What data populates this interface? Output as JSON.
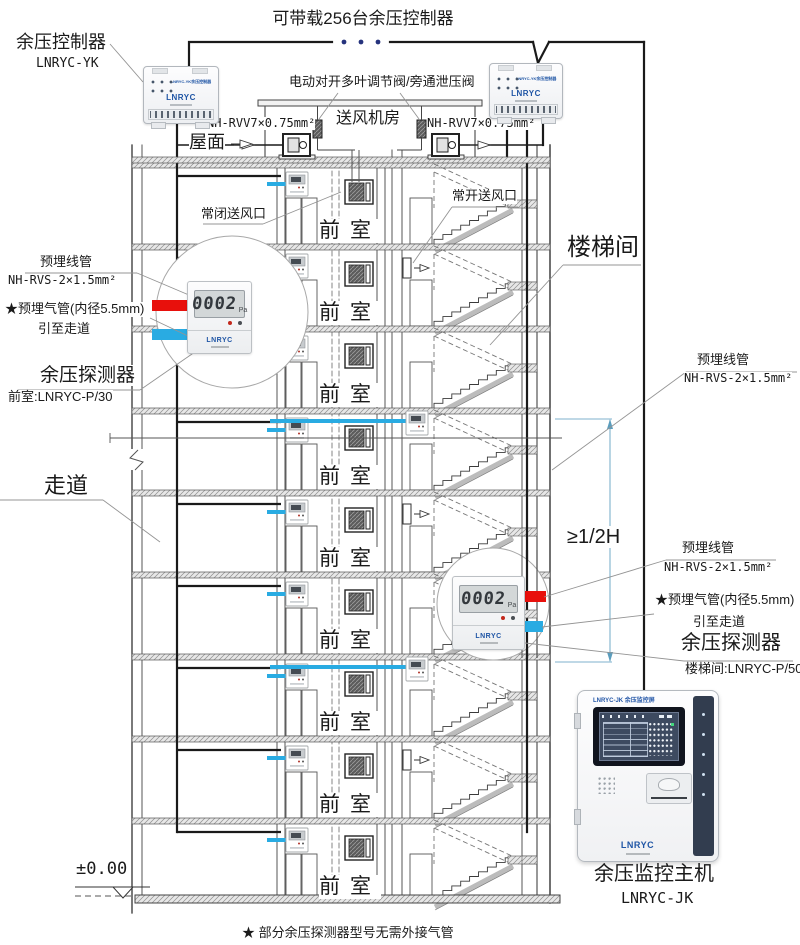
{
  "title": "可带载256台余压控制器",
  "top": {
    "controller_label": "余压控制器",
    "controller_model": "LNRYC-YK",
    "valve_label": "电动对开多叶调节阀/旁通泄压阀",
    "cable_spec": "NH-RVV7×0.75mm²",
    "fan_room_label": "送风机房",
    "roof_label": "屋面"
  },
  "controller_device": {
    "nameplate": "LNRYC-YK余压控制器",
    "logo": "LNRYC"
  },
  "building": {
    "closed_vent_label": "常闭送风口",
    "open_vent_label": "常开送风口",
    "stairwell_label": "楼梯间",
    "vestibule_label": "前室",
    "corridor_label": "走道",
    "height_dimension": "≥1/2H",
    "ground_level": "±0.00"
  },
  "right_conduit": {
    "label": "预埋线管",
    "spec": "NH-RVS-2×1.5mm²"
  },
  "detector_left": {
    "conduit_label": "预埋线管",
    "conduit_spec": "NH-RVS-2×1.5mm²",
    "air_tube_label": "★预埋气管(内径5.5mm)",
    "air_tube_dest": "引至走道",
    "name": "余压探测器",
    "model": "前室:LNRYC-P/30",
    "display_value": "0002",
    "display_unit": "Pa",
    "logo": "LNRYC"
  },
  "detector_right": {
    "conduit_label": "预埋线管",
    "conduit_spec": "NH-RVS-2×1.5mm²",
    "air_tube_label": "★预埋气管(内径5.5mm)",
    "air_tube_dest": "引至走道",
    "name": "余压探测器",
    "model": "楼梯间:LNRYC-P/50",
    "display_value": "0002",
    "display_unit": "Pa",
    "logo": "LNRYC"
  },
  "host": {
    "nameplate": "LNRYC-JK 余压监控屏",
    "name": "余压监控主机",
    "model": "LNRYC-JK",
    "logo": "LNRYC"
  },
  "footnote": "★ 部分余压探测器型号无需外接气管",
  "colors": {
    "pipe_red": "#e8100c",
    "pipe_blue": "#29abe2",
    "logo_blue": "#1f55a5",
    "wire_dark": "#1a1a1a"
  }
}
